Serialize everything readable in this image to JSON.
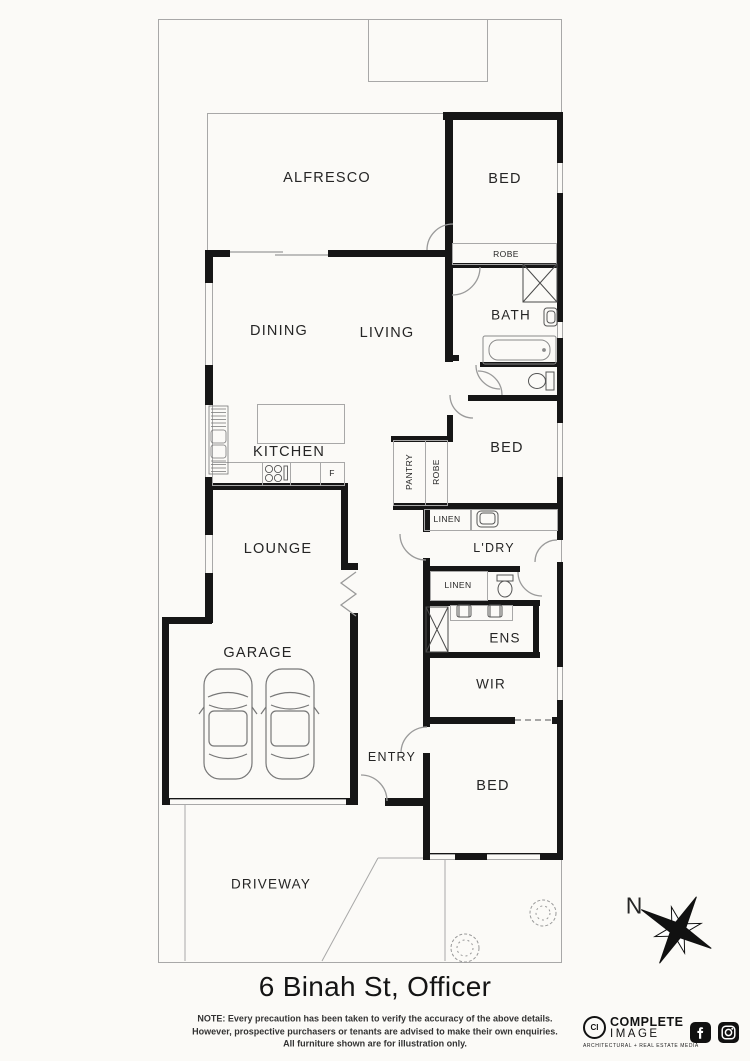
{
  "floorplan": {
    "title": "6 Binah St, Officer",
    "note": {
      "line1": "NOTE: Every precaution has been taken to verify the accuracy of the above details.",
      "line2": "However, prospective purchasers or tenants are advised to make their own enquiries.",
      "line3": "All furniture shown are for illustration only."
    },
    "compass_label": "N",
    "rooms": {
      "alfresco": "ALFRESCO",
      "bed_top": "BED",
      "robe_top": "ROBE",
      "bath": "BATH",
      "dining": "DINING",
      "living": "LIVING",
      "kitchen": "KITCHEN",
      "fridge": "F",
      "pantry": "PANTRY",
      "robe_mid": "ROBE",
      "bed_mid": "BED",
      "linen_1": "LINEN",
      "ldry": "L'DRY",
      "lounge": "LOUNGE",
      "linen_2": "LINEN",
      "ens": "ENS",
      "wir": "WIR",
      "garage": "GARAGE",
      "entry": "ENTRY",
      "bed_bottom": "BED",
      "driveway": "DRIVEWAY"
    },
    "branding": {
      "monogram": "CI",
      "name_line1": "COMPLETE",
      "name_line2": "IMAGE",
      "tagline": "ARCHITECTURAL + REAL ESTATE MEDIA"
    },
    "colors": {
      "wall": "#161616",
      "thin_line": "#a8a8a8",
      "background": "#fbfaf7",
      "text": "#252525"
    }
  }
}
